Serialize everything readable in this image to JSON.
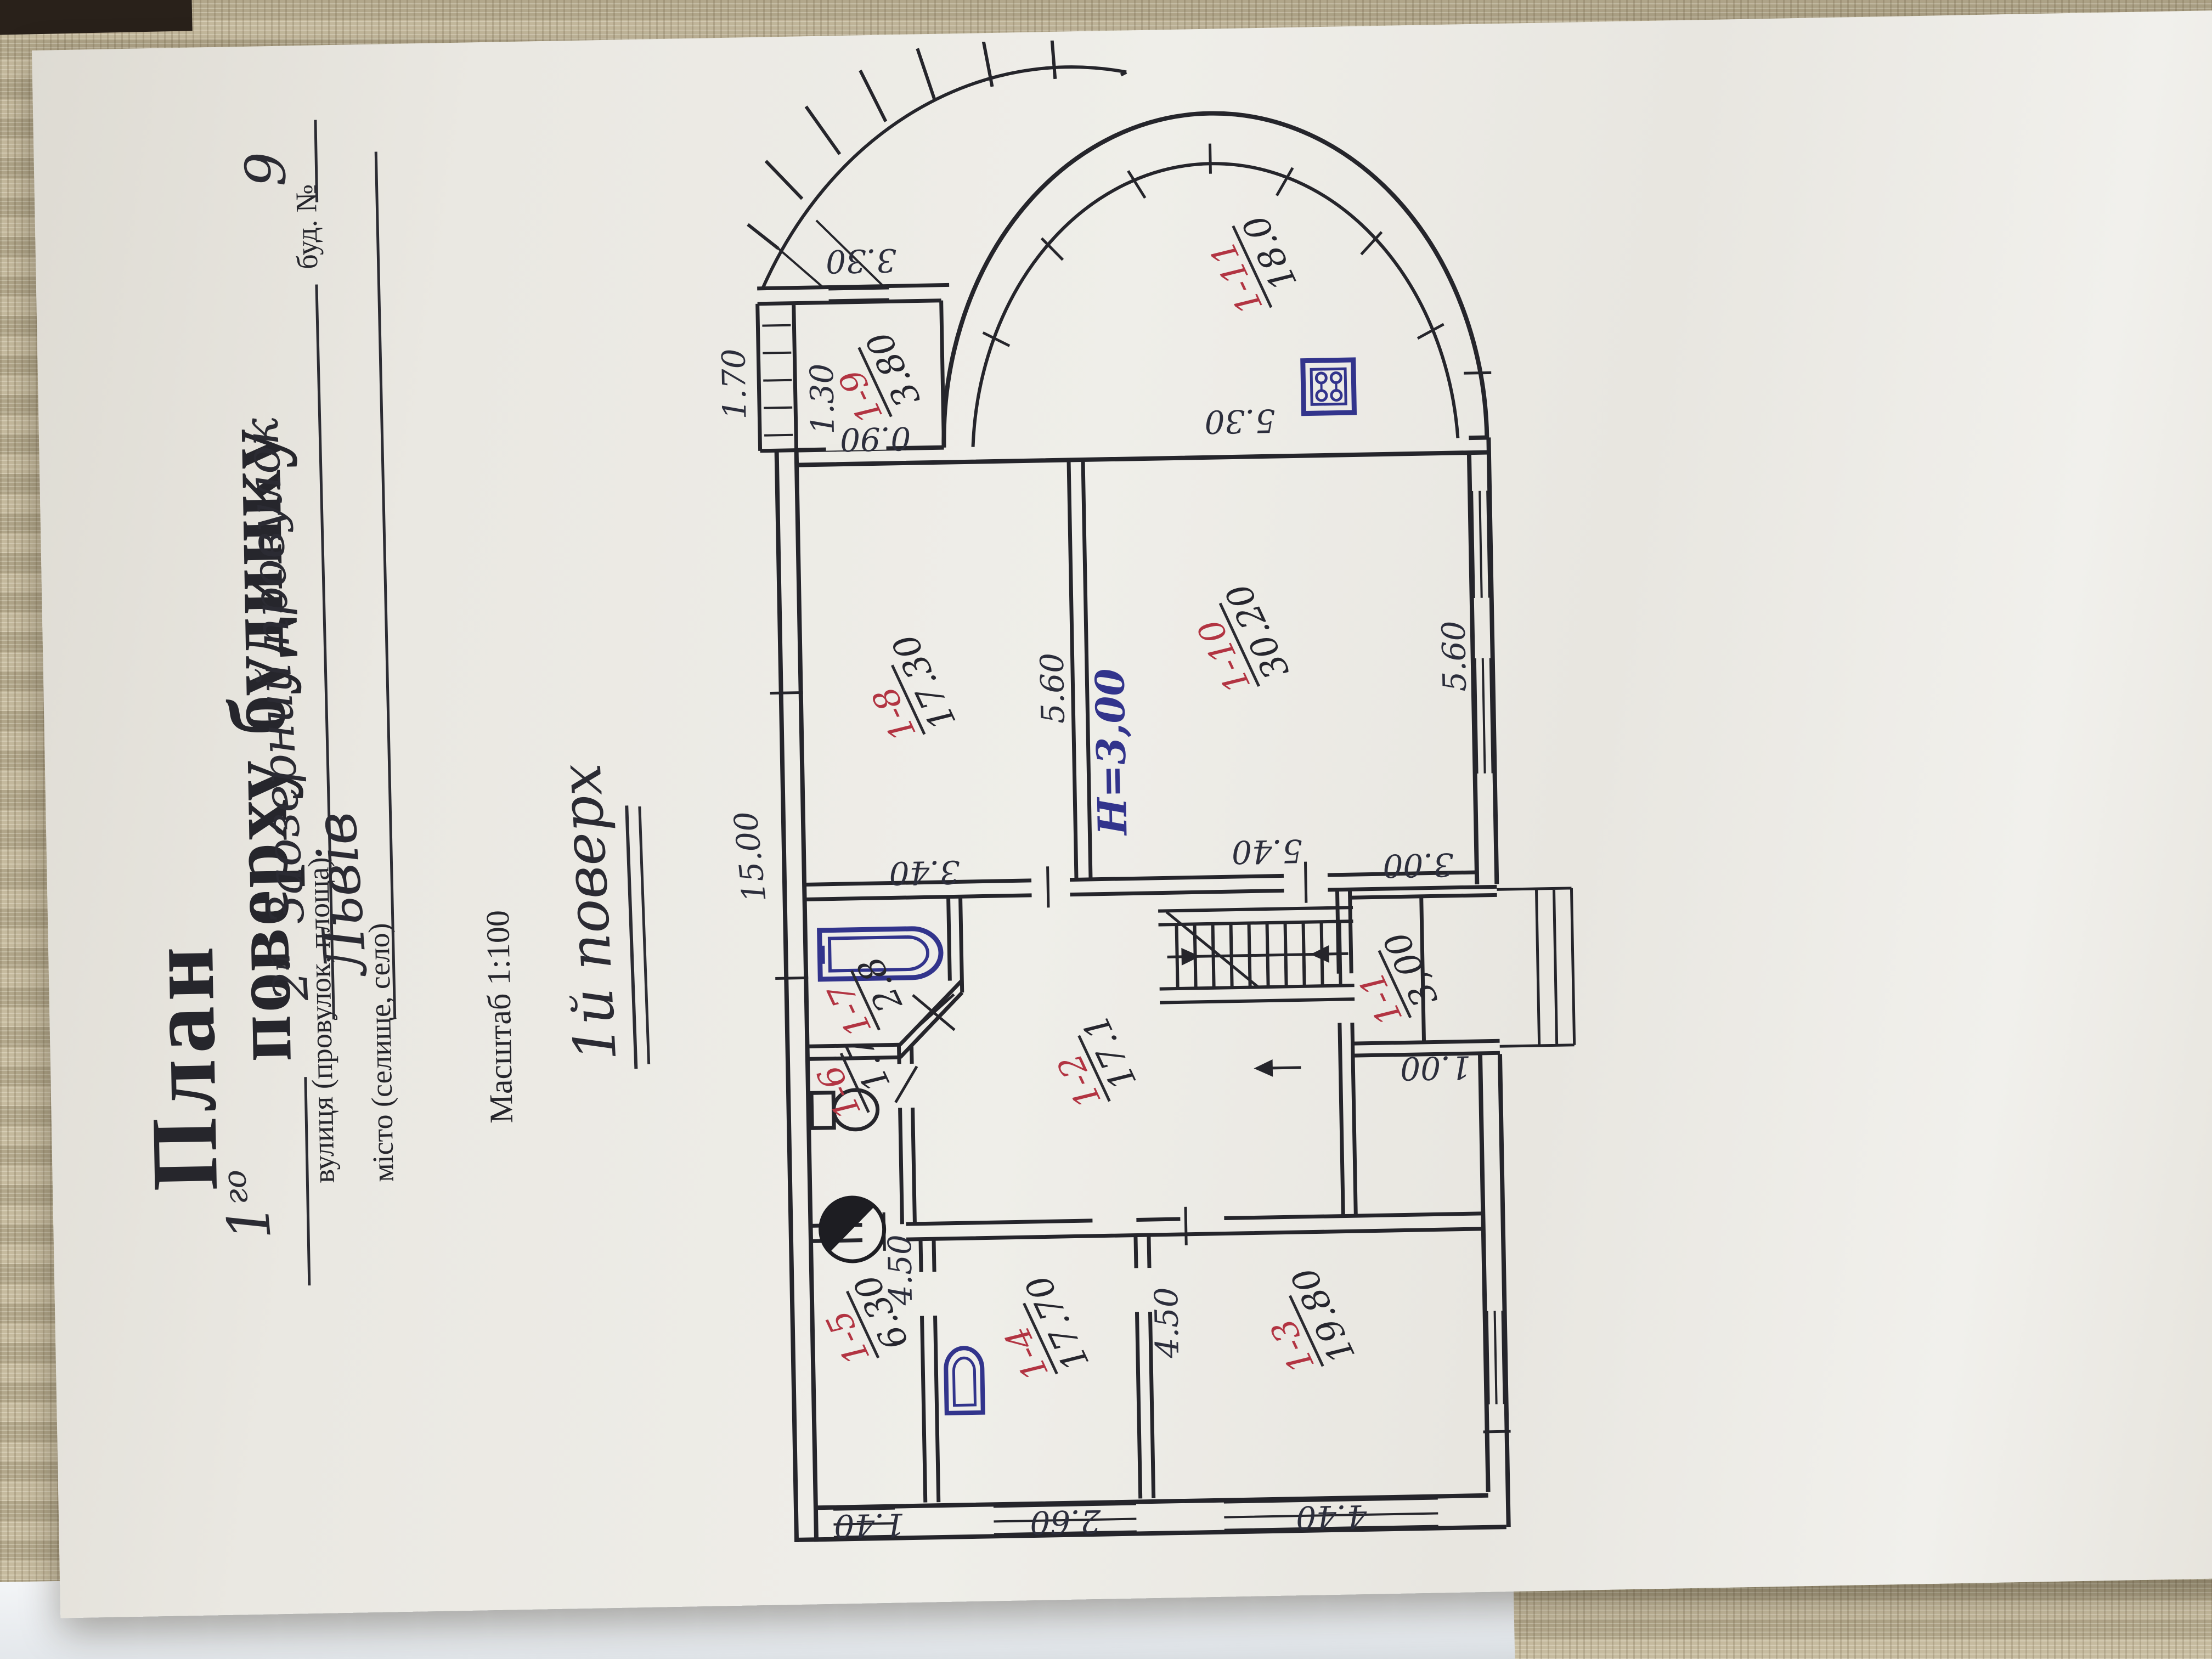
{
  "document": {
    "title": "План",
    "floor_blank": "1",
    "floor_blank_sup": "го",
    "title_rest": "поверху будинку",
    "street_label": "вулиця (провулок, площа)",
    "street_value_num": "2",
    "street_value_sup": "й",
    "street_value": "Заозерний провулок",
    "building_label": "буд. №",
    "building_value": "9",
    "city_label": "місто (селище, село)",
    "city_value": "Львів",
    "scale_note": "Масштаб 1:100",
    "floor_note": "1й поверх"
  },
  "plan": {
    "height_note": "Н=3,00",
    "rooms": [
      {
        "id": "1-1",
        "area": "3,00"
      },
      {
        "id": "1-2",
        "area": "17.1"
      },
      {
        "id": "1-3",
        "area": "19.80"
      },
      {
        "id": "1-4",
        "area": "17.70"
      },
      {
        "id": "1-5",
        "area": "6.30"
      },
      {
        "id": "1-6",
        "area": "1.7"
      },
      {
        "id": "1-7",
        "area": "2.8"
      },
      {
        "id": "1-8",
        "area": "17.30"
      },
      {
        "id": "1-9",
        "area": "3.80"
      },
      {
        "id": "1-10",
        "area": "30.20"
      },
      {
        "id": "1-11",
        "area": "18.0"
      }
    ],
    "dims": {
      "overall": "15.00",
      "porch": "1.70",
      "r9_w": "1.30",
      "r9_door": "0.90",
      "r9_side": "3.30",
      "bay_chord": "5.30",
      "r8_w": "5.60",
      "corr": "3.40",
      "r10_w": "5.60",
      "r10_d": "5.40",
      "r5_d": "4.50",
      "r3_d": "4.50",
      "r5_w": "1.40",
      "r4_win": "2.60",
      "r3_w": "4.40",
      "r1_l": "3.00",
      "r1_w": "1.00"
    },
    "colors": {
      "ink": "#26262c",
      "blue_ink": "#32348c",
      "red_ink": "#b23442",
      "paper": "#ecebe5",
      "mat": "#bcb194"
    }
  }
}
